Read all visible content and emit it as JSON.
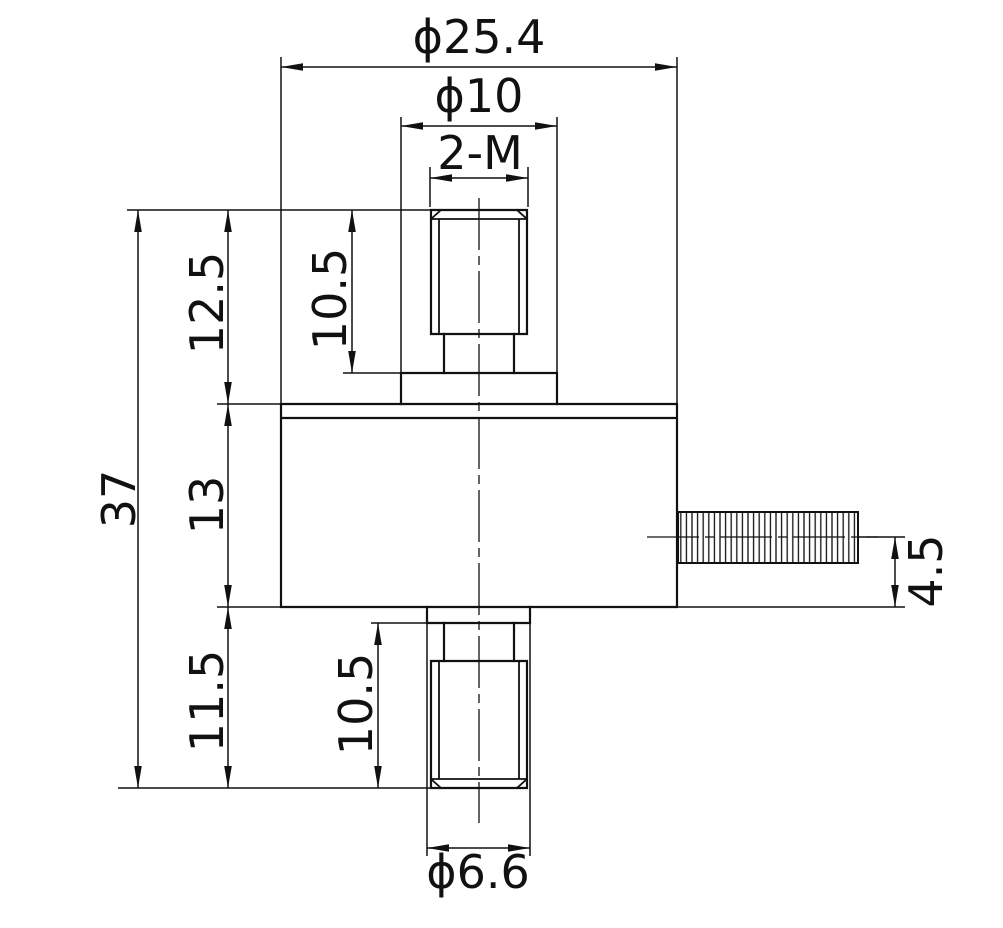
{
  "drawing": {
    "background_color": "#ffffff",
    "line_color": "#111111",
    "dimensions": {
      "overall_width_dia": "ϕ25.4",
      "boss_dia": "ϕ10",
      "thread_label": "2-M",
      "overall_height": "37",
      "upper_section_height": "12.5",
      "body_height": "13",
      "lower_section_height": "11.5",
      "upper_thread_length": "10.5",
      "lower_thread_length": "10.5",
      "cable_axis_offset": "4.5",
      "stud_step_dia": "ϕ6.6"
    }
  }
}
